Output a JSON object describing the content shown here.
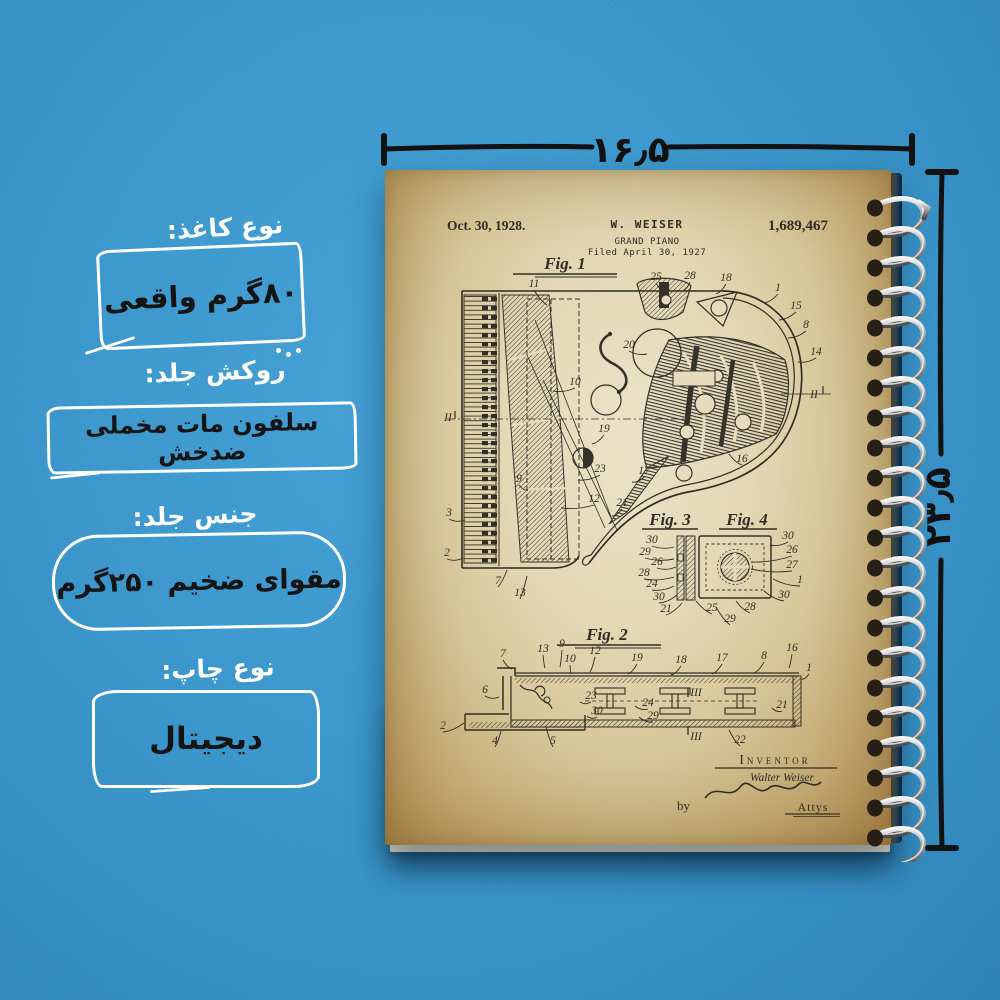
{
  "dimensions": {
    "width_cm": "۱۶٫۵",
    "height_cm": "۲۳٫۵"
  },
  "product_labels": {
    "paper": {
      "heading": "نوع کاغذ:",
      "value": "۸۰گرم واقعی"
    },
    "lamination": {
      "heading": "روکش جلد:",
      "value": "سلفون مات مخملی ضدخش"
    },
    "cover_material": {
      "heading": "جنس جلد:",
      "value": "مقوای ضخیم ۲۵۰گرم"
    },
    "print_type": {
      "heading": "نوع چاپ:",
      "value": "دیجیتال"
    }
  },
  "patent": {
    "date": "Oct. 30, 1928.",
    "header_name": "W. WEISER",
    "number": "1,689,467",
    "title": "GRAND PIANO",
    "filed": "Filed April 30, 1927",
    "figures": {
      "fig1": "Fig. 1",
      "fig2": "Fig. 2",
      "fig3": "Fig. 3",
      "fig4": "Fig. 4"
    },
    "inventor_label": "Inventor",
    "inventor_name": "Walter Weiser",
    "by": "by",
    "attys": "Attys",
    "callouts": {
      "fig1": [
        {
          "t": "11",
          "x": 149,
          "y": 117,
          "lx": 162,
          "ly": 135
        },
        {
          "t": "25",
          "x": 271,
          "y": 110,
          "lx": 279,
          "ly": 121
        },
        {
          "t": "28",
          "x": 305,
          "y": 109,
          "lx": 299,
          "ly": 120
        },
        {
          "t": "18",
          "x": 341,
          "y": 111,
          "lx": 331,
          "ly": 124
        },
        {
          "t": "1",
          "x": 393,
          "y": 121,
          "lx": 379,
          "ly": 133
        },
        {
          "t": "15",
          "x": 411,
          "y": 139,
          "lx": 394,
          "ly": 150
        },
        {
          "t": "8",
          "x": 421,
          "y": 158,
          "lx": 403,
          "ly": 168
        },
        {
          "t": "14",
          "x": 431,
          "y": 185,
          "lx": 413,
          "ly": 192
        },
        {
          "t": "II",
          "x": 429,
          "y": 228
        },
        {
          "t": "20",
          "x": 244,
          "y": 178,
          "lx": 262,
          "ly": 184
        },
        {
          "t": "10",
          "x": 190,
          "y": 215,
          "lx": 168,
          "ly": 221
        },
        {
          "t": "19",
          "x": 219,
          "y": 262,
          "lx": 207,
          "ly": 274
        },
        {
          "t": "23",
          "x": 215,
          "y": 302,
          "lx": 193,
          "ly": 310
        },
        {
          "t": "12",
          "x": 209,
          "y": 332,
          "lx": 176,
          "ly": 338
        },
        {
          "t": "9",
          "x": 134,
          "y": 312,
          "lx": 143,
          "ly": 320
        },
        {
          "t": "3",
          "x": 64,
          "y": 346,
          "lx": 80,
          "ly": 350
        },
        {
          "t": "2",
          "x": 62,
          "y": 386,
          "lx": 78,
          "ly": 388
        },
        {
          "t": "7",
          "x": 113,
          "y": 414,
          "lx": 122,
          "ly": 400
        },
        {
          "t": "13",
          "x": 135,
          "y": 426,
          "lx": 142,
          "ly": 406
        },
        {
          "t": "16",
          "x": 357,
          "y": 292,
          "lx": 344,
          "ly": 284
        },
        {
          "t": "17",
          "x": 259,
          "y": 304,
          "lx": 247,
          "ly": 312
        },
        {
          "t": "21",
          "x": 237,
          "y": 336,
          "lx": 227,
          "ly": 346
        },
        {
          "t": "II",
          "x": 63,
          "y": 251
        }
      ],
      "fig34": [
        {
          "t": "30",
          "x": 267,
          "y": 373,
          "lx": 289,
          "ly": 377
        },
        {
          "t": "29",
          "x": 260,
          "y": 385,
          "lx": 289,
          "ly": 389
        },
        {
          "t": "26",
          "x": 272,
          "y": 395,
          "lx": 291,
          "ly": 397
        },
        {
          "t": "28",
          "x": 259,
          "y": 406,
          "lx": 289,
          "ly": 407
        },
        {
          "t": "24",
          "x": 267,
          "y": 417,
          "lx": 289,
          "ly": 416
        },
        {
          "t": "30",
          "x": 274,
          "y": 430,
          "lx": 292,
          "ly": 425
        },
        {
          "t": "21",
          "x": 281,
          "y": 442,
          "lx": 297,
          "ly": 433
        },
        {
          "t": "25",
          "x": 327,
          "y": 441,
          "lx": 311,
          "ly": 431
        },
        {
          "t": "29",
          "x": 345,
          "y": 452,
          "lx": 331,
          "ly": 437
        },
        {
          "t": "28",
          "x": 365,
          "y": 440,
          "lx": 351,
          "ly": 431
        },
        {
          "t": "30",
          "x": 403,
          "y": 369,
          "lx": 385,
          "ly": 375
        },
        {
          "t": "26",
          "x": 407,
          "y": 383,
          "lx": 367,
          "ly": 392
        },
        {
          "t": "27",
          "x": 407,
          "y": 398,
          "lx": 366,
          "ly": 399
        },
        {
          "t": "1",
          "x": 415,
          "y": 413,
          "lx": 388,
          "ly": 409
        },
        {
          "t": "30",
          "x": 399,
          "y": 428,
          "lx": 379,
          "ly": 421
        }
      ],
      "fig2": [
        {
          "t": "7",
          "x": 118,
          "y": 487,
          "lx": 127,
          "ly": 499
        },
        {
          "t": "13",
          "x": 158,
          "y": 482,
          "lx": 160,
          "ly": 498
        },
        {
          "t": "9",
          "x": 177,
          "y": 477,
          "lx": 175,
          "ly": 497
        },
        {
          "t": "10",
          "x": 185,
          "y": 492,
          "lx": 186,
          "ly": 504
        },
        {
          "t": "12",
          "x": 210,
          "y": 484,
          "lx": 205,
          "ly": 502
        },
        {
          "t": "19",
          "x": 252,
          "y": 491,
          "lx": 243,
          "ly": 504
        },
        {
          "t": "18",
          "x": 296,
          "y": 493,
          "lx": 286,
          "ly": 505
        },
        {
          "t": "17",
          "x": 337,
          "y": 491,
          "lx": 327,
          "ly": 504
        },
        {
          "t": "8",
          "x": 379,
          "y": 489,
          "lx": 369,
          "ly": 503
        },
        {
          "t": "16",
          "x": 407,
          "y": 481,
          "lx": 404,
          "ly": 498
        },
        {
          "t": "1",
          "x": 424,
          "y": 501,
          "lx": 416,
          "ly": 509
        },
        {
          "t": "6",
          "x": 100,
          "y": 523,
          "lx": 114,
          "ly": 527
        },
        {
          "t": "2",
          "x": 58,
          "y": 559,
          "lx": 79,
          "ly": 553
        },
        {
          "t": "4",
          "x": 110,
          "y": 574,
          "lx": 116,
          "ly": 561
        },
        {
          "t": "5",
          "x": 168,
          "y": 574,
          "lx": 161,
          "ly": 557
        },
        {
          "t": "23",
          "x": 206,
          "y": 529,
          "lx": 195,
          "ly": 532
        },
        {
          "t": "30",
          "x": 212,
          "y": 544,
          "lx": 202,
          "ly": 546
        },
        {
          "t": "24",
          "x": 263,
          "y": 536,
          "lx": 250,
          "ly": 536
        },
        {
          "t": "29",
          "x": 268,
          "y": 549,
          "lx": 254,
          "ly": 547
        },
        {
          "t": "21",
          "x": 397,
          "y": 538,
          "lx": 387,
          "ly": 538
        },
        {
          "t": "22",
          "x": 355,
          "y": 573,
          "lx": 344,
          "ly": 560
        },
        {
          "t": "III",
          "x": 311,
          "y": 526
        },
        {
          "t": "III",
          "x": 311,
          "y": 570
        }
      ]
    }
  }
}
